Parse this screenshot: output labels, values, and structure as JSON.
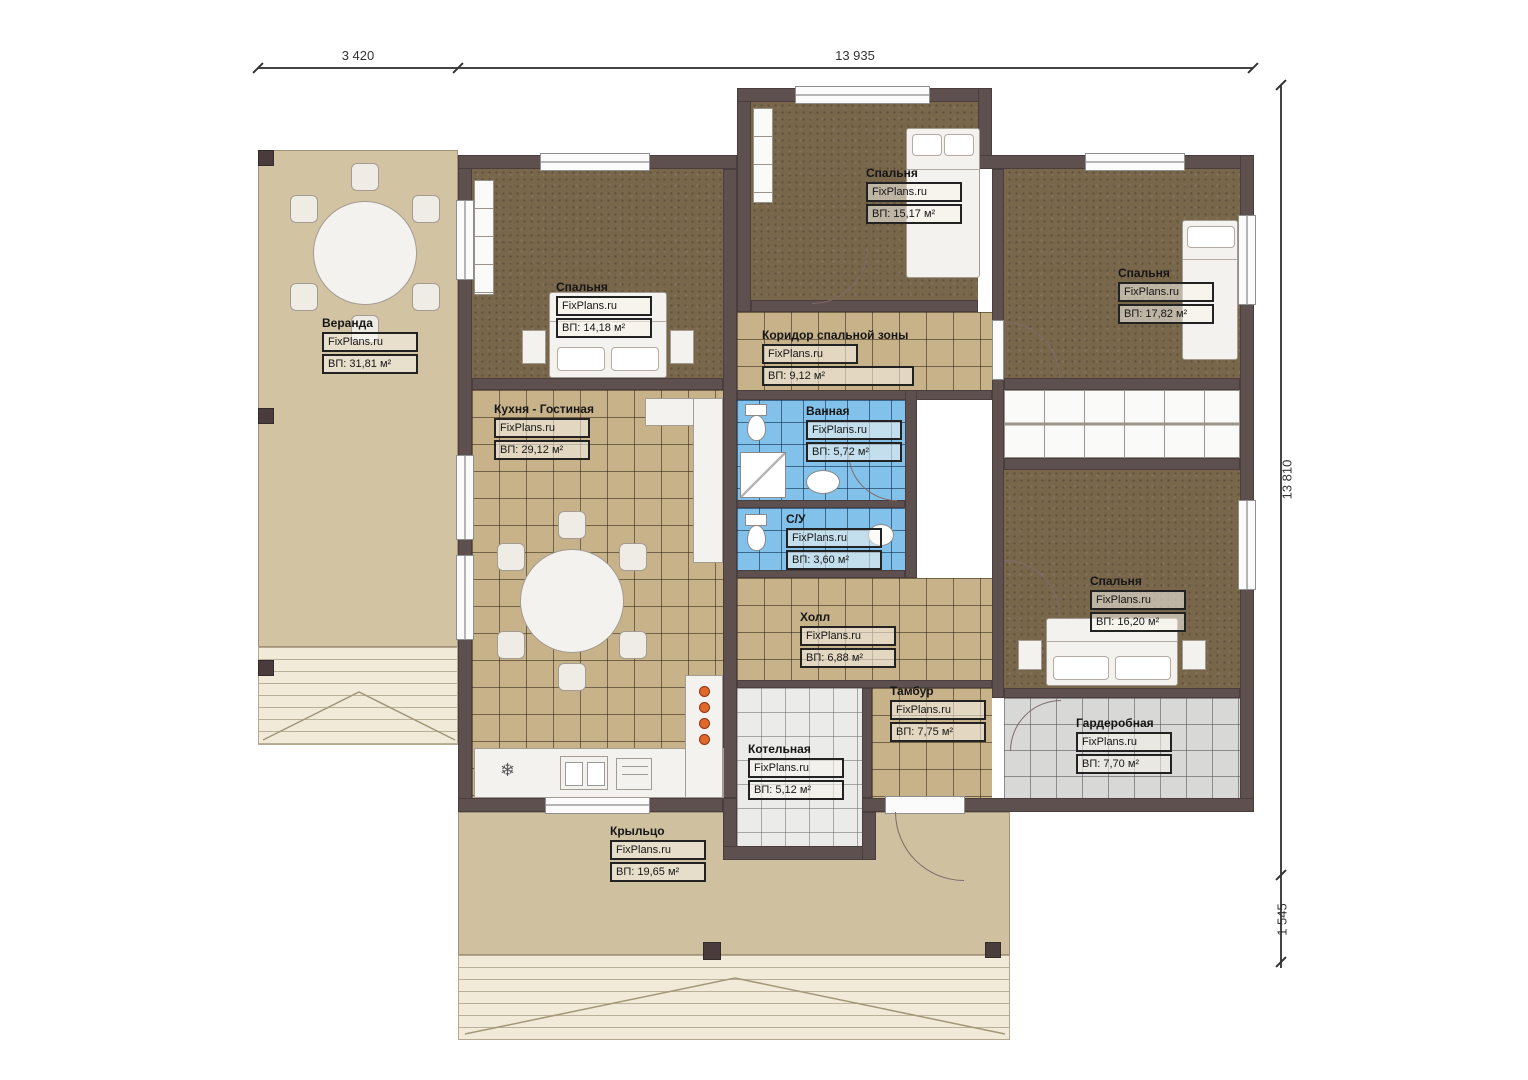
{
  "brand": "FixPlans.ru",
  "dimensions": {
    "top_left": "3 420",
    "top_main": "13 935",
    "right_main": "13 810",
    "right_bottom": "1 545"
  },
  "rooms": [
    {
      "name": "Веранда",
      "brand": "FixPlans.ru",
      "area": "ВП: 31,81 м²"
    },
    {
      "name": "Спальня",
      "brand": "FixPlans.ru",
      "area": "ВП: 14,18 м²"
    },
    {
      "name": "Спальня",
      "brand": "FixPlans.ru",
      "area": "ВП: 15,17 м²"
    },
    {
      "name": "Спальня",
      "brand": "FixPlans.ru",
      "area": "ВП: 17,82 м²"
    },
    {
      "name": "Коридор спальной зоны",
      "brand": "FixPlans.ru",
      "area": "ВП: 9,12 м²"
    },
    {
      "name": "Кухня - Гостиная",
      "brand": "FixPlans.ru",
      "area": "ВП: 29,12 м²"
    },
    {
      "name": "Ванная",
      "brand": "FixPlans.ru",
      "area": "ВП: 5,72 м²"
    },
    {
      "name": "С/У",
      "brand": "FixPlans.ru",
      "area": "ВП: 3,60 м²"
    },
    {
      "name": "Холл",
      "brand": "FixPlans.ru",
      "area": "ВП: 6,88 м²"
    },
    {
      "name": "Спальня",
      "brand": "FixPlans.ru",
      "area": "ВП: 16,20 м²"
    },
    {
      "name": "Тамбур",
      "brand": "FixPlans.ru",
      "area": "ВП: 7,75 м²"
    },
    {
      "name": "Котельная",
      "brand": "FixPlans.ru",
      "area": "ВП: 5,12 м²"
    },
    {
      "name": "Гардеробная",
      "brand": "FixPlans.ru",
      "area": "ВП: 7,70 м²"
    },
    {
      "name": "Крыльцо",
      "brand": "FixPlans.ru",
      "area": "ВП: 19,65 м²"
    }
  ],
  "glyphs": {
    "snowflake": "❄"
  },
  "palette": {
    "wall": "#5f5050",
    "bedroom_floor": "#79674c",
    "tile_tan": "#c7b28a",
    "tile_blue": "#82c2ea",
    "veranda": "#d2c3a3",
    "burner_accent": "#e2672b"
  }
}
